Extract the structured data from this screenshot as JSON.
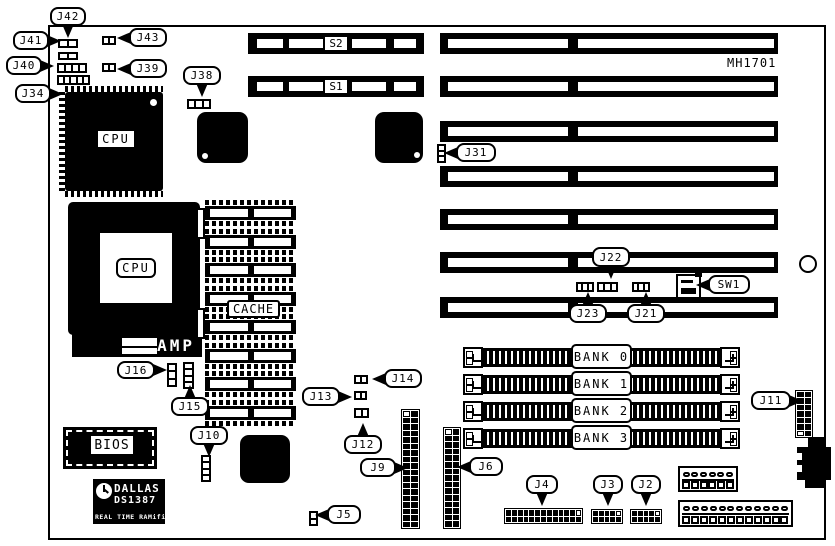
{
  "board": {
    "model_text": "MH1701",
    "outline": {
      "x": 48,
      "y": 25,
      "w": 778,
      "h": 515
    },
    "mounting_hole": {
      "x": 799,
      "y": 255,
      "d": 18
    }
  },
  "texts": {
    "cpu_qfp": "CPU",
    "cpu_socket": "CPU",
    "amp": "AMP",
    "cache": "CACHE",
    "bios": "BIOS"
  },
  "rtc": {
    "brand": "DALLAS",
    "part": "DS1387",
    "desc": "REAL TIME RAMified"
  },
  "slots": {
    "s_slots": [
      {
        "label": "S2",
        "x": 248,
        "y": 33,
        "w": 176,
        "h": 21
      },
      {
        "label": "S1",
        "x": 248,
        "y": 76,
        "w": 176,
        "h": 21
      }
    ],
    "right_slots": [
      {
        "x": 440,
        "y": 33,
        "w": 338,
        "h": 21
      },
      {
        "x": 440,
        "y": 76,
        "w": 338,
        "h": 21
      },
      {
        "x": 440,
        "y": 121,
        "w": 338,
        "h": 21
      },
      {
        "x": 440,
        "y": 166,
        "w": 338,
        "h": 21
      },
      {
        "x": 440,
        "y": 209,
        "w": 338,
        "h": 21
      },
      {
        "x": 440,
        "y": 252,
        "w": 338,
        "h": 21
      },
      {
        "x": 440,
        "y": 297,
        "w": 338,
        "h": 21
      }
    ],
    "banks": [
      {
        "label": "BANK 0",
        "x": 463,
        "y": 347,
        "w": 277,
        "h": 21
      },
      {
        "label": "BANK 1",
        "x": 463,
        "y": 374,
        "w": 277,
        "h": 21
      },
      {
        "label": "BANK 2",
        "x": 463,
        "y": 401,
        "w": 277,
        "h": 21
      },
      {
        "label": "BANK 3",
        "x": 463,
        "y": 428,
        "w": 277,
        "h": 21
      }
    ]
  },
  "cache_column": {
    "x": 205,
    "y": 200,
    "count": 8,
    "pitch": 28.5
  },
  "callouts": [
    {
      "id": "J42",
      "label": "J42",
      "x": 50,
      "y": 7,
      "w": 36,
      "h": 19,
      "dir": "down"
    },
    {
      "id": "J41",
      "label": "J41",
      "x": 13,
      "y": 31,
      "w": 36,
      "h": 19,
      "dir": "right"
    },
    {
      "id": "J40",
      "label": "J40",
      "x": 6,
      "y": 56,
      "w": 36,
      "h": 19,
      "dir": "right"
    },
    {
      "id": "J34",
      "label": "J34",
      "x": 15,
      "y": 84,
      "w": 36,
      "h": 19,
      "dir": "right"
    },
    {
      "id": "J43",
      "label": "J43",
      "x": 129,
      "y": 28,
      "w": 38,
      "h": 19,
      "dir": "left"
    },
    {
      "id": "J39",
      "label": "J39",
      "x": 129,
      "y": 59,
      "w": 38,
      "h": 19,
      "dir": "left"
    },
    {
      "id": "J38",
      "label": "J38",
      "x": 183,
      "y": 66,
      "w": 38,
      "h": 19,
      "dir": "down"
    },
    {
      "id": "J31",
      "label": "J31",
      "x": 456,
      "y": 143,
      "w": 40,
      "h": 19,
      "dir": "left"
    },
    {
      "id": "J22",
      "label": "J22",
      "x": 592,
      "y": 247,
      "w": 38,
      "h": 20,
      "dir": "down"
    },
    {
      "id": "J23",
      "label": "J23",
      "x": 569,
      "y": 304,
      "w": 38,
      "h": 19,
      "dir": "up"
    },
    {
      "id": "J21",
      "label": "J21",
      "x": 627,
      "y": 304,
      "w": 38,
      "h": 19,
      "dir": "up"
    },
    {
      "id": "SW1",
      "label": "SW1",
      "x": 708,
      "y": 275,
      "w": 42,
      "h": 19,
      "dir": "left"
    },
    {
      "id": "J16",
      "label": "J16",
      "x": 117,
      "y": 361,
      "w": 38,
      "h": 18,
      "dir": "right"
    },
    {
      "id": "J15",
      "label": "J15",
      "x": 171,
      "y": 397,
      "w": 38,
      "h": 19,
      "dir": "up"
    },
    {
      "id": "J14",
      "label": "J14",
      "x": 384,
      "y": 369,
      "w": 38,
      "h": 19,
      "dir": "left"
    },
    {
      "id": "J13",
      "label": "J13",
      "x": 302,
      "y": 387,
      "w": 38,
      "h": 19,
      "dir": "right"
    },
    {
      "id": "J12",
      "label": "J12",
      "x": 344,
      "y": 435,
      "w": 38,
      "h": 19,
      "dir": "up"
    },
    {
      "id": "J11",
      "label": "J11",
      "x": 751,
      "y": 391,
      "w": 40,
      "h": 19,
      "dir": "right"
    },
    {
      "id": "J10",
      "label": "J10",
      "x": 190,
      "y": 426,
      "w": 38,
      "h": 19,
      "dir": "down"
    },
    {
      "id": "J9",
      "label": "J9",
      "x": 360,
      "y": 458,
      "w": 36,
      "h": 19,
      "dir": "right"
    },
    {
      "id": "J6",
      "label": "J6",
      "x": 469,
      "y": 457,
      "w": 34,
      "h": 19,
      "dir": "left"
    },
    {
      "id": "J5",
      "label": "J5",
      "x": 327,
      "y": 505,
      "w": 34,
      "h": 19,
      "dir": "left"
    },
    {
      "id": "J4",
      "label": "J4",
      "x": 526,
      "y": 475,
      "w": 32,
      "h": 19,
      "dir": "down"
    },
    {
      "id": "J3",
      "label": "J3",
      "x": 593,
      "y": 475,
      "w": 30,
      "h": 19,
      "dir": "down"
    },
    {
      "id": "J2",
      "label": "J2",
      "x": 631,
      "y": 475,
      "w": 30,
      "h": 19,
      "dir": "down"
    }
  ],
  "jumpers": [
    {
      "id": "j42",
      "x": 58,
      "y": 39,
      "w": 20,
      "h": 9,
      "cells": 2,
      "vert": false
    },
    {
      "id": "j41",
      "x": 58,
      "y": 52,
      "w": 20,
      "h": 8,
      "cells": 2,
      "vert": false
    },
    {
      "id": "j40",
      "x": 57,
      "y": 63,
      "w": 30,
      "h": 10,
      "cells": 4,
      "vert": false
    },
    {
      "id": "j34",
      "x": 57,
      "y": 75,
      "w": 33,
      "h": 10,
      "cells": 5,
      "vert": false
    },
    {
      "id": "j43",
      "x": 102,
      "y": 36,
      "w": 14,
      "h": 9,
      "cells": 2,
      "vert": false
    },
    {
      "id": "j39",
      "x": 102,
      "y": 63,
      "w": 14,
      "h": 9,
      "cells": 2,
      "vert": false
    },
    {
      "id": "j38",
      "x": 187,
      "y": 99,
      "w": 24,
      "h": 10,
      "cells": 3,
      "vert": false
    },
    {
      "id": "j31",
      "x": 437,
      "y": 144,
      "w": 9,
      "h": 19,
      "cells": 3,
      "vert": true
    },
    {
      "id": "j23",
      "x": 576,
      "y": 282,
      "w": 18,
      "h": 10,
      "cells": 3,
      "vert": false
    },
    {
      "id": "j22",
      "x": 597,
      "y": 282,
      "w": 21,
      "h": 10,
      "cells": 3,
      "vert": false
    },
    {
      "id": "j21",
      "x": 632,
      "y": 282,
      "w": 18,
      "h": 10,
      "cells": 3,
      "vert": false
    },
    {
      "id": "j16",
      "x": 167,
      "y": 363,
      "w": 10,
      "h": 24,
      "cells": 3,
      "vert": true
    },
    {
      "id": "j15",
      "x": 183,
      "y": 362,
      "w": 11,
      "h": 27,
      "cells": 4,
      "vert": true
    },
    {
      "id": "j14",
      "x": 354,
      "y": 375,
      "w": 14,
      "h": 9,
      "cells": 2,
      "vert": false
    },
    {
      "id": "j13",
      "x": 354,
      "y": 391,
      "w": 13,
      "h": 9,
      "cells": 2,
      "vert": false
    },
    {
      "id": "j12",
      "x": 354,
      "y": 408,
      "w": 15,
      "h": 10,
      "cells": 2,
      "vert": false
    },
    {
      "id": "j10",
      "x": 201,
      "y": 455,
      "w": 10,
      "h": 27,
      "cells": 4,
      "vert": true
    },
    {
      "id": "j5",
      "x": 309,
      "y": 511,
      "w": 9,
      "h": 15,
      "cells": 2,
      "vert": true
    }
  ],
  "grid_connectors": [
    {
      "id": "j9",
      "x": 401,
      "y": 409,
      "w": 19,
      "h": 120,
      "cols": 2,
      "rows": 18,
      "white": [
        0
      ]
    },
    {
      "id": "j6",
      "x": 443,
      "y": 427,
      "w": 18,
      "h": 102,
      "cols": 2,
      "rows": 15,
      "white": [
        0
      ]
    },
    {
      "id": "j11",
      "x": 795,
      "y": 390,
      "w": 18,
      "h": 48,
      "cols": 2,
      "rows": 7,
      "white": [
        12
      ]
    },
    {
      "id": "j4",
      "x": 504,
      "y": 508,
      "w": 79,
      "h": 16,
      "cols": 13,
      "rows": 2,
      "white": [
        12
      ]
    },
    {
      "id": "j3",
      "x": 591,
      "y": 509,
      "w": 32,
      "h": 15,
      "cols": 5,
      "rows": 2,
      "white": [
        4
      ]
    },
    {
      "id": "j2",
      "x": 630,
      "y": 509,
      "w": 32,
      "h": 15,
      "cols": 5,
      "rows": 2,
      "white": [
        4
      ]
    }
  ],
  "power_connectors": [
    {
      "id": "ps1",
      "x": 678,
      "y": 466,
      "w": 60,
      "h": 26,
      "pins": 6
    },
    {
      "id": "ps2",
      "x": 678,
      "y": 500,
      "w": 115,
      "h": 27,
      "pins": 12
    }
  ]
}
